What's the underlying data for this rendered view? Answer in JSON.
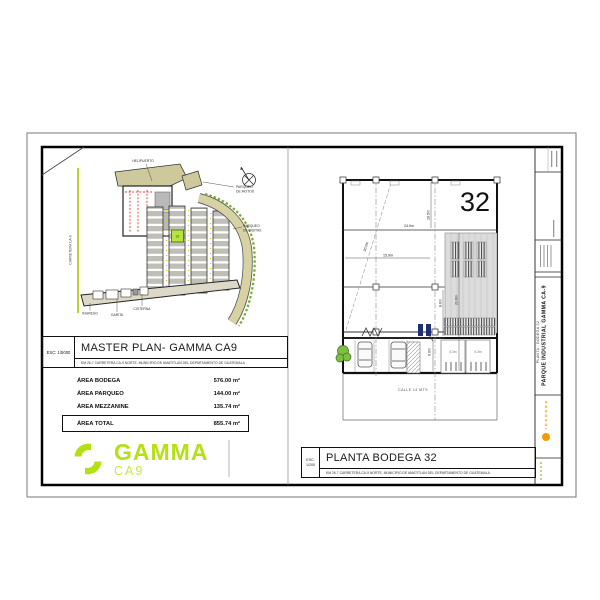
{
  "colors": {
    "brand_green": "#b3e114",
    "unit_highlight": "#b7e441",
    "road_beige": "#d6d2a4",
    "accent_orange": "#f59b00",
    "door_navy": "#1e2f73"
  },
  "master_plan": {
    "title": "MASTER PLAN- GAMMA CA9",
    "scale": "ESC: 1/5000",
    "address": "KM 26.7 CARRETERA CA-9 NORTE, MUNICIPIO DE AMATITLAN DEL DEPARTAMENTO DE GUATEMALA",
    "labels": {
      "helipuerto": "HELIPUERTO",
      "parqueo_motos": [
        "PARQUEO",
        "DE MOTOS"
      ],
      "parqueo_visitas": [
        "PARQUEO",
        "DE VISITAS"
      ],
      "carretera": "CARRETERA CA-9",
      "ingreso": "INGRESO",
      "garita": "GARITA",
      "cisterna": "CISTERNA",
      "highlighted_unit": "32"
    }
  },
  "area_table": {
    "rows": [
      {
        "label": "ÁREA BODEGA",
        "value": "576.00 m²"
      },
      {
        "label": "ÁREA PARQUEO",
        "value": "144.00 m²"
      },
      {
        "label": "ÁREA MEZZANINE",
        "value": "135.74 m²"
      }
    ],
    "total": {
      "label": "ÁREA TOTAL",
      "value": "855.74 m²"
    }
  },
  "logo": {
    "name": "GAMMA",
    "sub": "CA9"
  },
  "floor_plan": {
    "unit_number": "32",
    "title": "PLANTA BODEGA 32",
    "scale": "ESC: 1/200",
    "address": "KM 26.7 CARRETERA CA-9 NORTE, MUNICIPIO DE AMATITLAN DEL DEPARTAMENTO DE GUATEMALA",
    "street": "CALLE 14 MTS",
    "dims": {
      "width_top": "24.0m",
      "right_upper": "16.5m",
      "diagonal": "30.0m",
      "mid_width": "15.9m",
      "right_full": "21.6m",
      "right_lower": "8.6m",
      "parking_depth": "6.0m",
      "dock_left": "5.3m",
      "dock_right": "5.3m"
    }
  },
  "title_strip": {
    "project": "PARQUE INDUSTRIAL GAMMA CA-9",
    "sheet": "PLANTA - BODEGA 32"
  }
}
